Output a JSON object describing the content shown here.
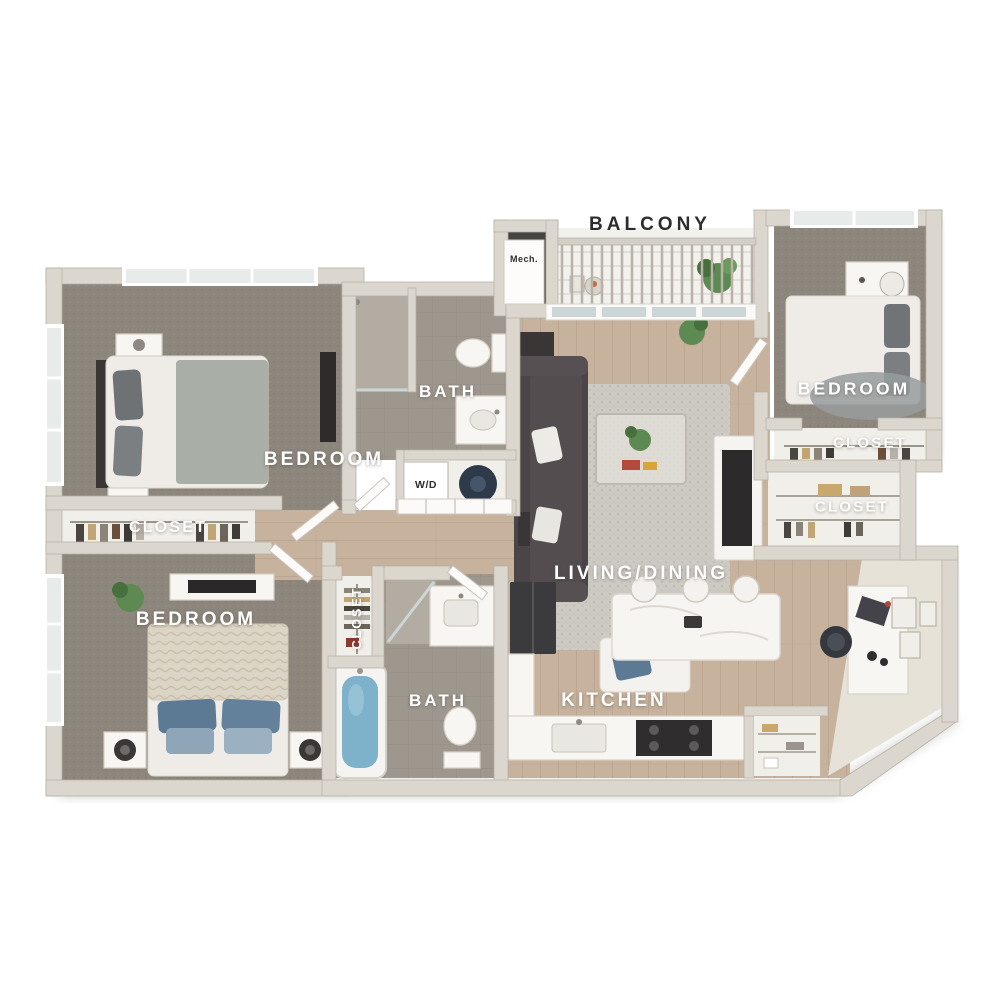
{
  "image_type": "3D apartment floor plan (top-down dollhouse view), 3 bed / 2 bath unit",
  "labels": {
    "balcony": "BALCONY",
    "mech": "Mech.",
    "bath_upper": "BATH",
    "bedroom_top_left": "BEDROOM",
    "closet_left": "CLOSET",
    "bedroom_bottom_left": "BEDROOM",
    "closet_linen": "CLOSET",
    "bath_lower": "BATH",
    "kitchen": "KITCHEN",
    "living_dining": "LIVING/DINING",
    "bedroom_right": "BEDROOM",
    "closet_right_upper": "CLOSET",
    "closet_right_lower": "CLOSET",
    "laundry": "W/D"
  },
  "palette": {
    "wall": "#dcd7ce",
    "wall_edge": "#b5afa4",
    "carpet": "#8d867c",
    "wood": "#c7b29d",
    "wood_line": "#b49f8a",
    "tile": "#9e978e",
    "tile_light": "#b3aca2",
    "floor_light": "#f1efea",
    "nook_floor": "#e6e2d7",
    "mech_floor": "#474441",
    "water": "#7db2ca",
    "sofa": "#4b4547",
    "rug": "#cdcac3",
    "plant": "#5d8a52",
    "pillow_blue": "#5d7a94",
    "furniture_dark": "#343132",
    "furniture_white": "#f8f6f3",
    "furn_stroke": "#d6d1c8",
    "glass": "#ccd6d6",
    "label_light": "#ffffff",
    "label_dark": "#2d2d2d"
  }
}
